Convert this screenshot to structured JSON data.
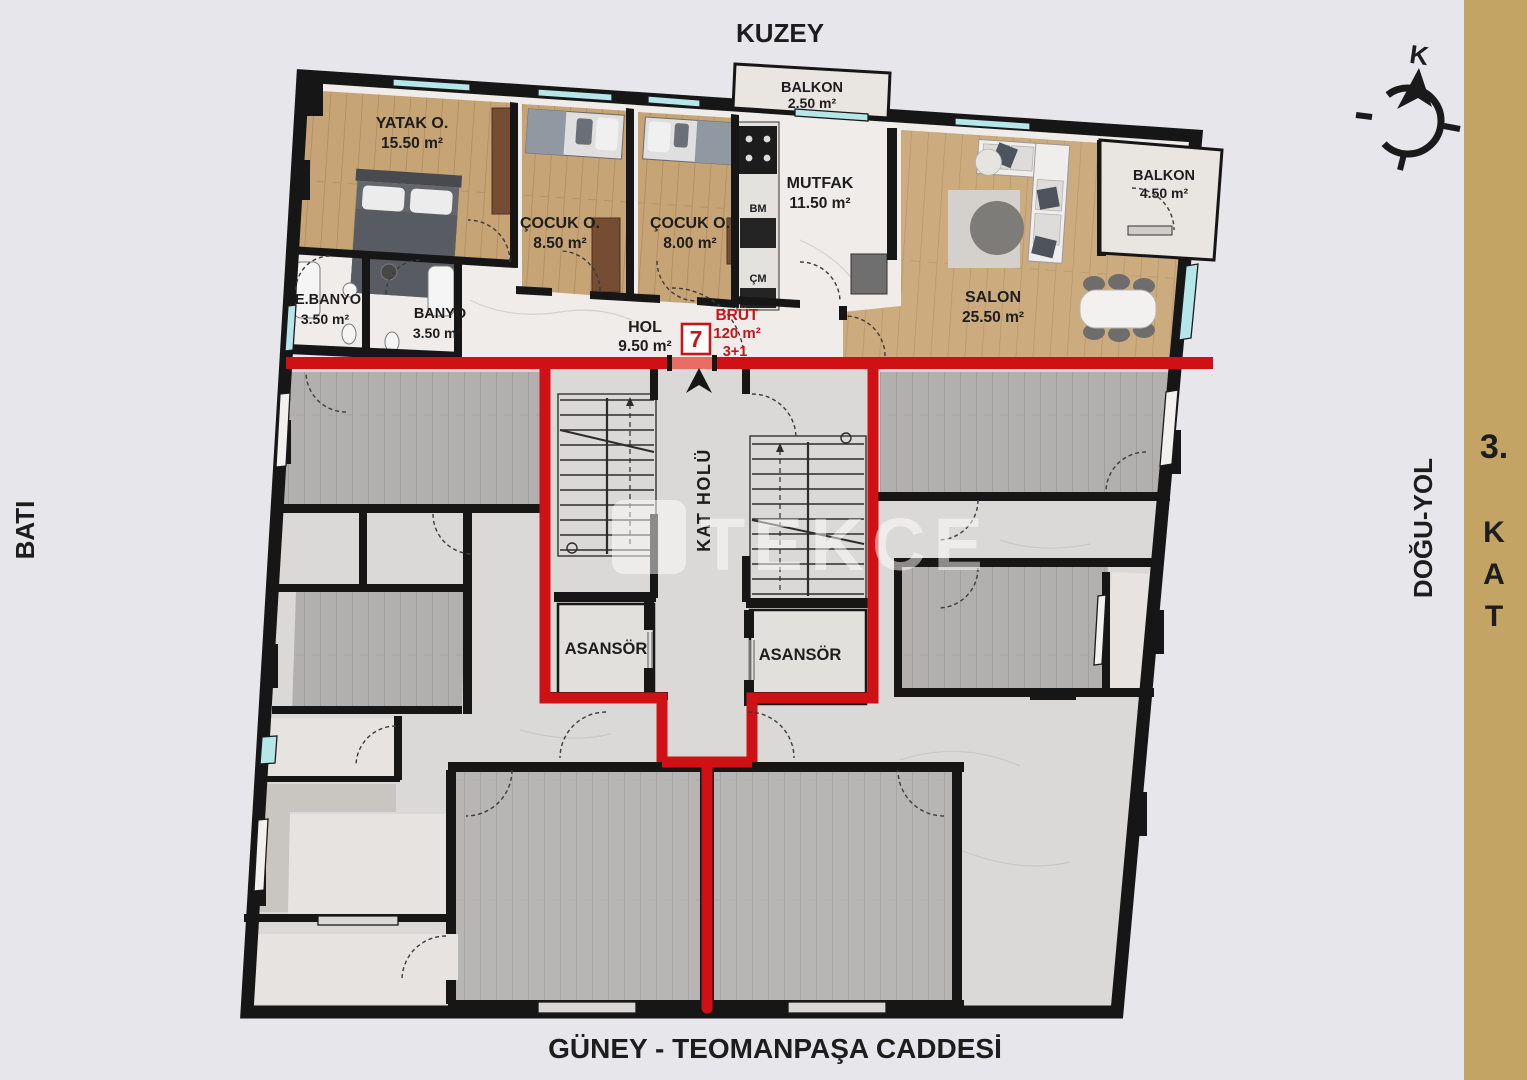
{
  "canvas": {
    "background": "#e7e6ea",
    "side_strip_color": "#c4a464",
    "accent_red": "#cf1116",
    "wall_color": "#161616",
    "window_color": "#b5e7ea",
    "wood_tan": "#c6a476",
    "wood_gray": "#b1b0ae",
    "marble_upper": "#efece9",
    "marble_lower": "#dbd9d7"
  },
  "orientation": {
    "north": "KUZEY",
    "west": "BATI",
    "east": "DOĞU-YOL",
    "south": "GÜNEY - TEOMANPAŞA CADDESİ",
    "compass_letter": "K"
  },
  "floor": {
    "number": "3.",
    "letters": [
      "K",
      "A",
      "T"
    ]
  },
  "unit": {
    "number": "7",
    "gross_label": "BRÜT",
    "gross_area": "120 m²",
    "room_layout": "3+1"
  },
  "rooms": {
    "yatak": {
      "name": "YATAK O.",
      "area": "15.50 m²"
    },
    "cocuk1": {
      "name": "ÇOCUK O.",
      "area": "8.50 m²"
    },
    "cocuk2": {
      "name": "ÇOCUK O.",
      "area": "8.00 m²"
    },
    "mutfak": {
      "name": "MUTFAK",
      "area": "11.50 m²"
    },
    "salon": {
      "name": "SALON",
      "area": "25.50 m²"
    },
    "balkon_kuzey": {
      "name": "BALKON",
      "area": "2.50 m²"
    },
    "balkon_dogu": {
      "name": "BALKON",
      "area": "4.50 m²"
    },
    "ebanyo": {
      "name": "E.BANYO",
      "area": "3.50 m²"
    },
    "banyo": {
      "name": "BANYO",
      "area": "3.50 m²"
    },
    "hol": {
      "name": "HOL",
      "area": "9.50 m²"
    },
    "kat_holu": {
      "name": "KAT HOLÜ"
    },
    "asansor_sol": {
      "name": "ASANSÖR"
    },
    "asansor_sag": {
      "name": "ASANSÖR"
    },
    "bm": "BM",
    "cm": "ÇM"
  },
  "watermark": {
    "text": "TEKCE"
  }
}
